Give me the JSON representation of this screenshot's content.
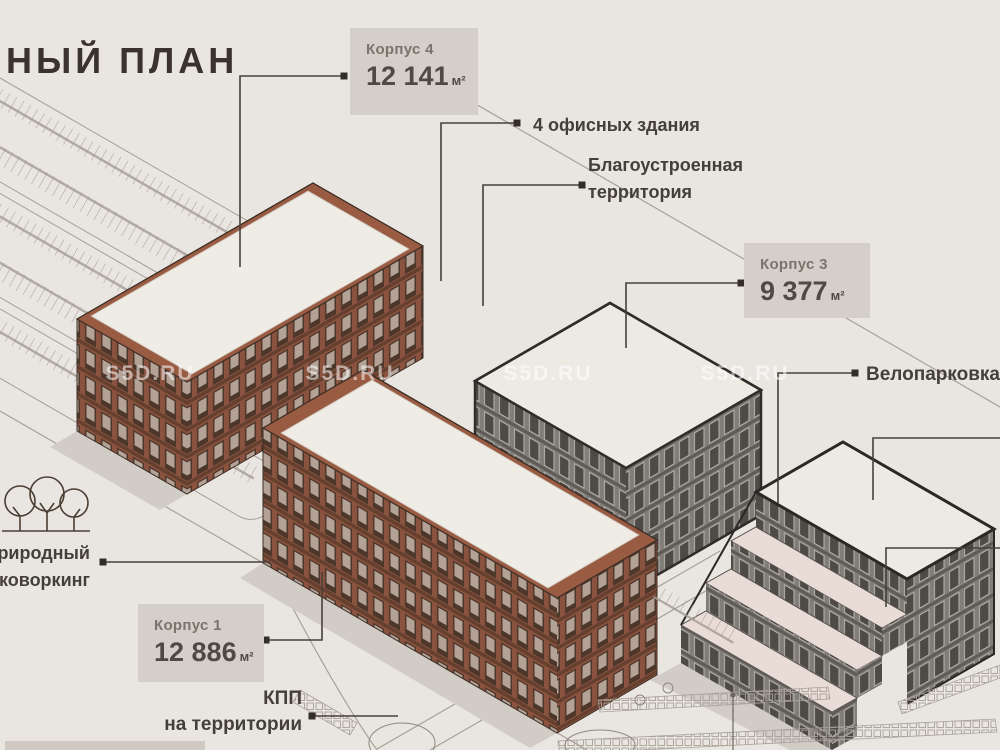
{
  "title": {
    "text": "НЫЙ ПЛАН"
  },
  "watermark": {
    "text": "S5D.RU"
  },
  "buildings": {
    "korpus4": {
      "label": "Корпус 4",
      "area": "12 141",
      "unit": "м²"
    },
    "korpus3": {
      "label": "Корпус 3",
      "area": "9 377",
      "unit": "м²"
    },
    "korpus1": {
      "label": "Корпус 1",
      "area": "12 886",
      "unit": "м²"
    }
  },
  "annotations": {
    "offices": "4 офисных здания",
    "landscaped": {
      "line1": "Благоустроенная",
      "line2": "территория"
    },
    "bike_parking": "Велопарковка",
    "nature_coworking": {
      "line1": "риродный",
      "line2": "коворкинг"
    },
    "checkpoint": {
      "line1": "КПП",
      "line2": "на территории"
    }
  },
  "colors": {
    "background": "#e9e6e1",
    "brick_facade": "#8a5340",
    "brick_parapet": "#9a5b43",
    "gray_facade": "#817d78",
    "roof_white": "#efece6",
    "terrace_pink": "#e9dbd5",
    "label_box": "#d4cfc9",
    "text_dark": "#453f39",
    "leader_line": "#474039"
  }
}
